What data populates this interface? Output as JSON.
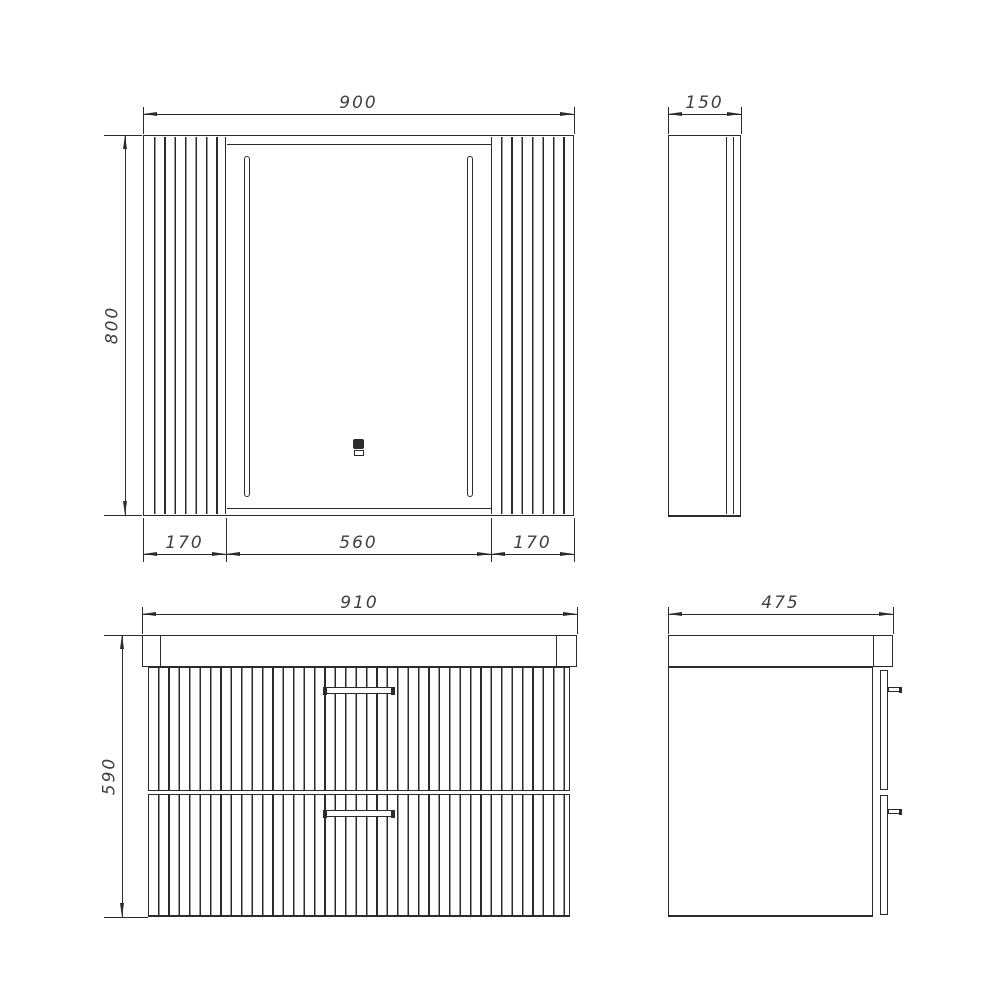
{
  "meta": {
    "drawing_type": "bathroom furniture technical dimension drawing",
    "views_count": 4
  },
  "colors": {
    "line": "#2b2b2b",
    "text": "#3f3f3f",
    "background": "#ffffff"
  },
  "icons": {
    "touch_sensor": "touch-sensor-icon",
    "led_strip": "led-strip"
  },
  "views": {
    "mirror_front": {
      "name": "mirror-cabinet-front-view",
      "dim_width": "900",
      "dim_height": "800",
      "dim_left_panel": "170",
      "dim_mirror_door": "560",
      "dim_right_panel": "170"
    },
    "mirror_side": {
      "name": "mirror-cabinet-side-view",
      "dim_depth": "150"
    },
    "vanity_front": {
      "name": "vanity-front-view",
      "dim_width": "910",
      "dim_height": "590"
    },
    "vanity_side": {
      "name": "vanity-side-view",
      "dim_depth": "475"
    }
  }
}
